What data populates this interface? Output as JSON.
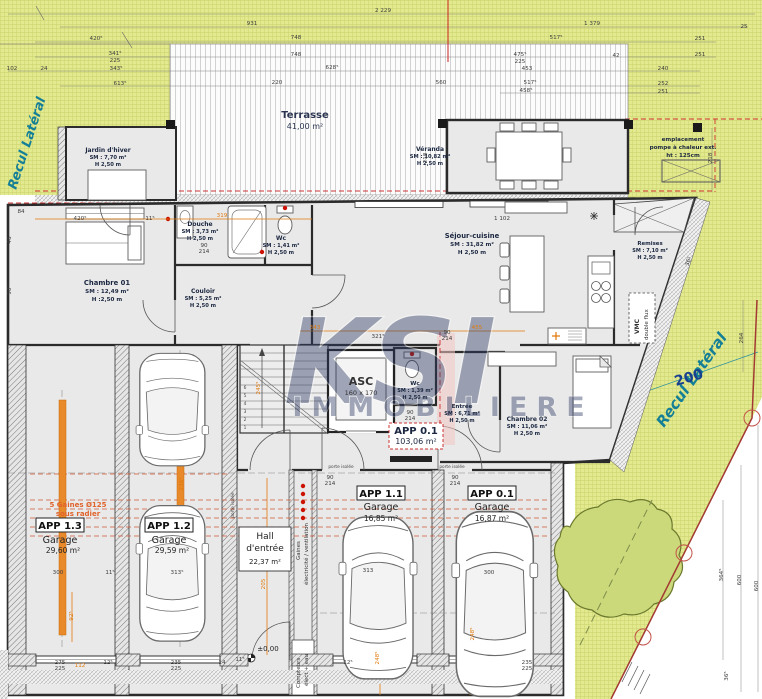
{
  "site": {
    "recul_left": "Recul Latéral",
    "recul_right": "Recul Latéral",
    "boundary_dim": "200",
    "pompe_l1": "emplacement",
    "pompe_l2": "pompe à chaleur ext.",
    "pompe_l3": "ht : 125cm"
  },
  "watermark": {
    "logo": "KSI",
    "name": "IMMOBILIERE"
  },
  "outdoor": {
    "terrasse_name": "Terrasse",
    "terrasse_area": "41,00 m²"
  },
  "rooms": {
    "jardin": {
      "name": "Jardin d'hiver",
      "sm": "SM : 7,70 m²",
      "h": "H 2,50 m"
    },
    "veranda": {
      "name": "Véranda",
      "sm": "SM : 10,82 m²",
      "h": "H 2,50 m"
    },
    "chambre01": {
      "name": "Chambre 01",
      "sm": "SM : 12,49 m²",
      "h": "H :2,50 m"
    },
    "douche": {
      "name": "Douche",
      "sm": "SM : 3,73 m²",
      "h": "H 2,50 m"
    },
    "wc1": {
      "name": "Wc",
      "sm": "SM : 1,41 m²",
      "h": "H 2,50 m"
    },
    "couloir": {
      "name": "Couloir",
      "sm": "SM : 5,25 m²",
      "h": "H 2,50 m"
    },
    "sejour": {
      "name": "Séjour-cuisine",
      "sm": "SM : 31,82 m²",
      "h": "H 2,50 m"
    },
    "remises": {
      "name": "Remises",
      "sm": "SM : 7,10 m²",
      "h": "H 2,50 m"
    },
    "asc": {
      "name": "ASC",
      "dims": "160 x 170"
    },
    "wc2": {
      "name": "Wc",
      "sm": "SM : 1,39 m²",
      "h": "H 2,50 m"
    },
    "entree": {
      "name": "Entrée",
      "sm": "SM : 6,71 m²",
      "h": "H 2,50 m"
    },
    "chambre02": {
      "name": "Chambre 02",
      "sm": "SM : 11,06 m²",
      "h": "H 2,50 m"
    },
    "app01": {
      "name": "APP 0.1",
      "area": "103,06 m²"
    },
    "hall": {
      "l1": "Hall",
      "l2": "d'entrée",
      "area": "22,37 m²"
    },
    "garage13": {
      "app": "APP 1.3",
      "type": "Garage",
      "area": "29,60 m²"
    },
    "garage12": {
      "app": "APP 1.2",
      "type": "Garage",
      "area": "29,59 m²"
    },
    "garage11": {
      "app": "APP 1.1",
      "type": "Garage",
      "area": "16,85 m²"
    },
    "garage01": {
      "app": "APP 0.1",
      "type": "Garage",
      "area": "16,87 m²"
    }
  },
  "annotations": {
    "gaines5a": "5 Gaines Ø125",
    "gaines5b": "sous radier",
    "gaines_v1": "Gaines",
    "gaines_v2": "électricité / ventilation",
    "compteurs1": "Compteurs",
    "compteurs2": "élect + eau",
    "vmc1": "VMC",
    "vmc2": "double flux",
    "level": "±0,00",
    "porte_isolee": "porte isolée"
  },
  "colors": {
    "grass": "#e3e98e",
    "accent_orange": "#e0790a",
    "boundary_red": "#a23a33",
    "teal": "#147f96",
    "navy": "#1b2740",
    "watermark_blue": "#2c3a64"
  },
  "dims": [
    {
      "x": 383,
      "y": 12,
      "t": "2 229"
    },
    {
      "x": 252,
      "y": 25,
      "t": "931"
    },
    {
      "x": 592,
      "y": 25,
      "t": "1 379"
    },
    {
      "x": 744,
      "y": 28,
      "t": "25"
    },
    {
      "x": 96,
      "y": 40,
      "t": "420⁵"
    },
    {
      "x": 296,
      "y": 39,
      "t": "748"
    },
    {
      "x": 556,
      "y": 39,
      "t": "517⁵"
    },
    {
      "x": 700,
      "y": 40,
      "t": "251"
    },
    {
      "x": 115,
      "y": 55,
      "t": "341⁵"
    },
    {
      "x": 115,
      "y": 62,
      "t": "225"
    },
    {
      "x": 296,
      "y": 56,
      "t": "748"
    },
    {
      "x": 520,
      "y": 56,
      "t": "475⁵"
    },
    {
      "x": 520,
      "y": 63,
      "t": "225"
    },
    {
      "x": 616,
      "y": 57,
      "t": "42"
    },
    {
      "x": 700,
      "y": 56,
      "t": "251"
    },
    {
      "x": 116,
      "y": 70,
      "t": "343⁵"
    },
    {
      "x": 44,
      "y": 70,
      "t": "24"
    },
    {
      "x": 12,
      "y": 70,
      "t": "102"
    },
    {
      "x": 332,
      "y": 69,
      "t": "628⁵"
    },
    {
      "x": 527,
      "y": 70,
      "t": "453"
    },
    {
      "x": 663,
      "y": 70,
      "t": "240"
    },
    {
      "x": 120,
      "y": 85,
      "t": "613⁵"
    },
    {
      "x": 277,
      "y": 84,
      "t": "220"
    },
    {
      "x": 441,
      "y": 84,
      "t": "560"
    },
    {
      "x": 530,
      "y": 84,
      "t": "517⁵"
    },
    {
      "x": 663,
      "y": 85,
      "t": "252"
    },
    {
      "x": 526,
      "y": 92,
      "t": "458⁵"
    },
    {
      "x": 663,
      "y": 93,
      "t": "251"
    },
    {
      "x": 21,
      "y": 213,
      "t": "84"
    },
    {
      "x": 80,
      "y": 220,
      "t": "420⁵"
    },
    {
      "x": 150,
      "y": 220,
      "t": "11⁵"
    },
    {
      "x": 502,
      "y": 220,
      "t": "1 102"
    },
    {
      "x": 427,
      "y": 158,
      "t": "218",
      "r": -90
    },
    {
      "x": 712,
      "y": 158,
      "t": "218",
      "r": -90
    },
    {
      "x": 743,
      "y": 338,
      "t": "264",
      "r": -90
    },
    {
      "x": 723,
      "y": 575,
      "t": "364⁵",
      "r": -90
    },
    {
      "x": 741,
      "y": 580,
      "t": "600",
      "r": -90
    },
    {
      "x": 758,
      "y": 586,
      "t": "600",
      "r": -90
    },
    {
      "x": 728,
      "y": 676,
      "t": "36⁵",
      "r": -90
    },
    {
      "x": 690,
      "y": 262,
      "t": "36⁵",
      "r": -70
    },
    {
      "x": 11,
      "y": 290,
      "t": "90⁷",
      "r": -90
    },
    {
      "x": 11,
      "y": 240,
      "t": "46",
      "r": -90
    },
    {
      "x": 204,
      "y": 247,
      "t": "90"
    },
    {
      "x": 204,
      "y": 253,
      "t": "214"
    },
    {
      "x": 447,
      "y": 334,
      "t": "90"
    },
    {
      "x": 447,
      "y": 340,
      "t": "214"
    },
    {
      "x": 410,
      "y": 414,
      "t": "90"
    },
    {
      "x": 410,
      "y": 420,
      "t": "214"
    },
    {
      "x": 330,
      "y": 479,
      "t": "90"
    },
    {
      "x": 330,
      "y": 485,
      "t": "214"
    },
    {
      "x": 455,
      "y": 479,
      "t": "90"
    },
    {
      "x": 455,
      "y": 485,
      "t": "214"
    },
    {
      "x": 378,
      "y": 338,
      "t": "321⁵"
    },
    {
      "x": 58,
      "y": 574,
      "t": "300"
    },
    {
      "x": 110,
      "y": 574,
      "t": "11⁵"
    },
    {
      "x": 177,
      "y": 574,
      "t": "313⁵"
    },
    {
      "x": 368,
      "y": 572,
      "t": "313"
    },
    {
      "x": 489,
      "y": 574,
      "t": "300"
    },
    {
      "x": 60,
      "y": 664,
      "t": "275"
    },
    {
      "x": 60,
      "y": 670,
      "t": "225"
    },
    {
      "x": 108,
      "y": 664,
      "t": "12⁵"
    },
    {
      "x": 176,
      "y": 664,
      "t": "235"
    },
    {
      "x": 176,
      "y": 670,
      "t": "225"
    },
    {
      "x": 222,
      "y": 664,
      "t": "14"
    },
    {
      "x": 240,
      "y": 661,
      "t": "11⁵"
    },
    {
      "x": 348,
      "y": 664,
      "t": "12⁵"
    },
    {
      "x": 527,
      "y": 664,
      "t": "235"
    },
    {
      "x": 527,
      "y": 670,
      "t": "225"
    },
    {
      "x": 222,
      "y": 217,
      "t": "319",
      "c": "o"
    },
    {
      "x": 315,
      "y": 329,
      "t": "343",
      "c": "o"
    },
    {
      "x": 477,
      "y": 329,
      "t": "455",
      "c": "o"
    },
    {
      "x": 73,
      "y": 616,
      "t": "92⁵",
      "c": "o",
      "r": -90
    },
    {
      "x": 265,
      "y": 584,
      "t": "205",
      "c": "o",
      "r": -90
    },
    {
      "x": 183,
      "y": 484,
      "t": "236⁵",
      "c": "o",
      "r": -90
    },
    {
      "x": 260,
      "y": 388,
      "t": "245⁵",
      "c": "o",
      "r": -90
    },
    {
      "x": 379,
      "y": 658,
      "t": "248⁵",
      "c": "o",
      "r": -90
    },
    {
      "x": 474,
      "y": 634,
      "t": "248⁵",
      "c": "o",
      "r": -90
    },
    {
      "x": 80,
      "y": 667,
      "t": "112",
      "c": "o"
    },
    {
      "x": 690,
      "y": 382,
      "t": "200",
      "c": "bl",
      "r": -16
    }
  ]
}
